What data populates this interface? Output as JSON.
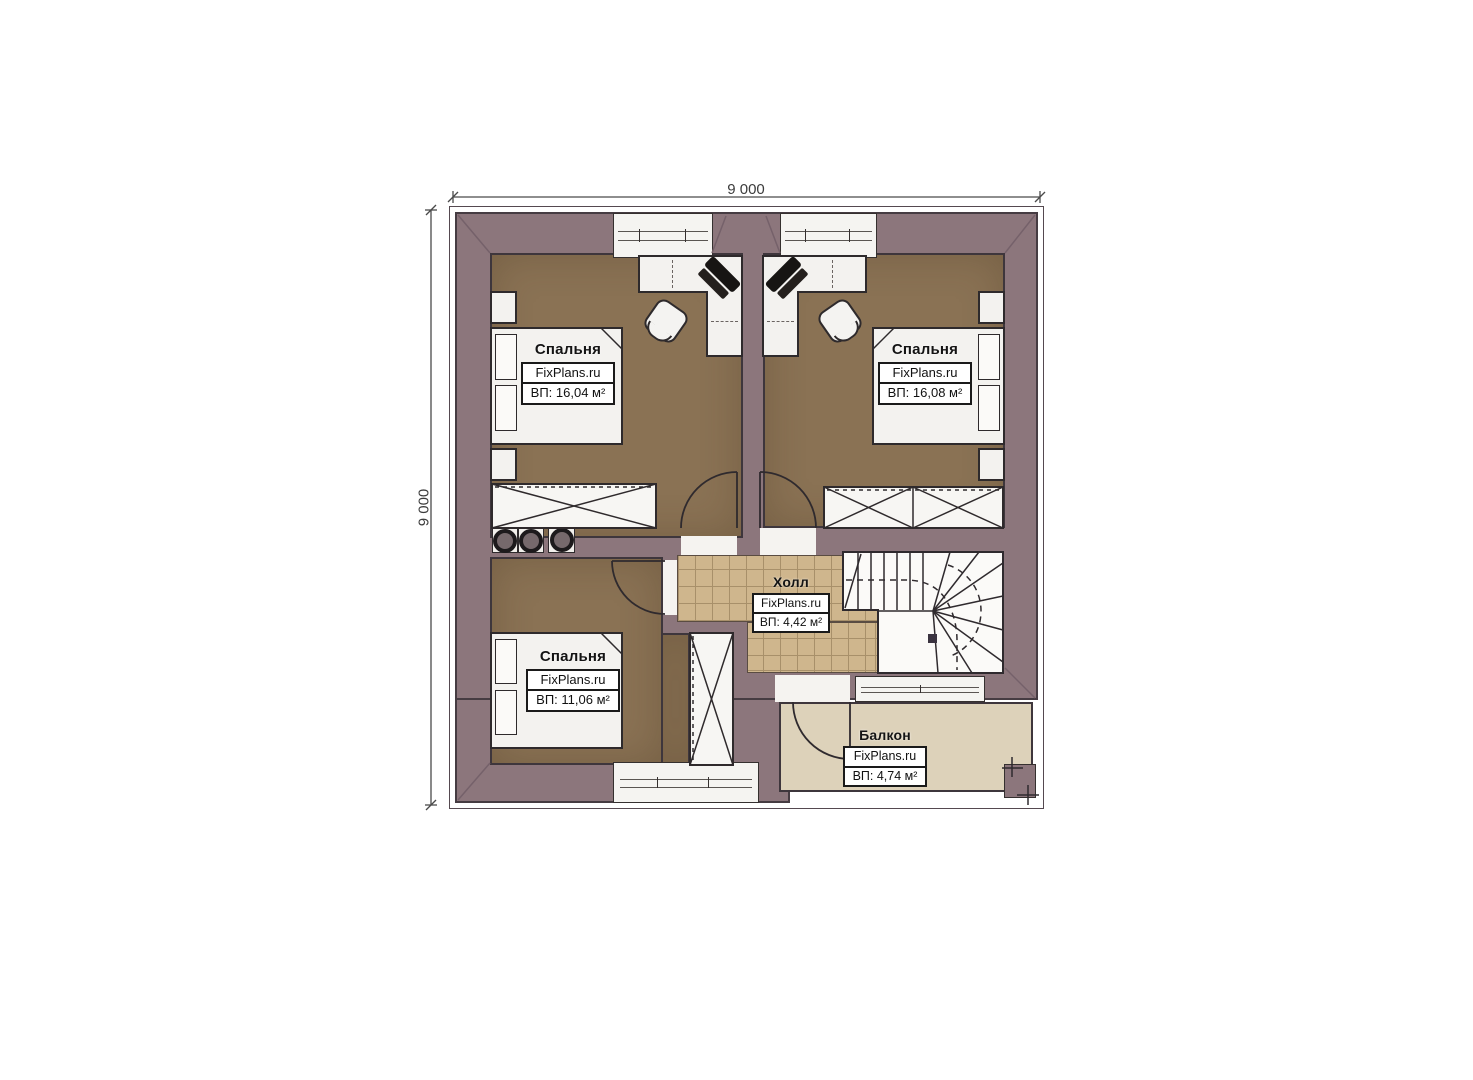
{
  "plan": {
    "type": "floor-plan",
    "dimensions": {
      "top": "9 000",
      "left": "9 000"
    },
    "rooms": {
      "bedroom1": {
        "title": "Спальня",
        "brand": "FixPlans.ru",
        "area": "ВП: 16,04 м²"
      },
      "bedroom2": {
        "title": "Спальня",
        "brand": "FixPlans.ru",
        "area": "ВП: 16,08 м²"
      },
      "bedroom3": {
        "title": "Спальня",
        "brand": "FixPlans.ru",
        "area": "ВП: 11,06 м²"
      },
      "hall": {
        "title": "Холл",
        "brand": "FixPlans.ru",
        "area": "ВП: 4,42 м²"
      },
      "balcony": {
        "title": "Балкон",
        "brand": "FixPlans.ru",
        "area": "ВП: 4,74 м²"
      }
    },
    "colors": {
      "wall": "#8c767c",
      "bedroom_floor": "#8a7254",
      "hall_tile": "#cfb68d",
      "balcony_floor": "#ddd2ba",
      "line": "#2e2a2c"
    }
  }
}
